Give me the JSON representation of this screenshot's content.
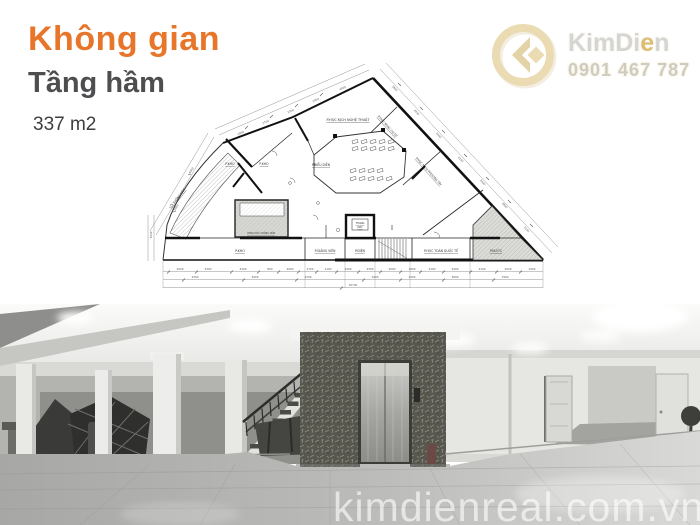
{
  "header": {
    "title": "Không gian",
    "subtitle": "Tầng hầm",
    "area": "337 m2"
  },
  "brand": {
    "name_pre": "KimDi",
    "name_accent": "e",
    "name_post": "n",
    "phone": "0901 467 787"
  },
  "photo_watermark": "kimdienreal.com.vn",
  "colors": {
    "accent_orange": "#e8762a",
    "title_gray": "#4e4e50",
    "logo_gold": "#e7d6aa",
    "plan_line": "#333333"
  },
  "plan": {
    "rooms": [
      {
        "t": "P.HỌC KỊCH NGHỆ THUẬT",
        "x": 208,
        "y": 46,
        "r": 0,
        "s": 3.4
      },
      {
        "t": "P.BIỂU DIỄN",
        "x": 181,
        "y": 91,
        "r": 0,
        "s": 3.1
      },
      {
        "t": "P.KHO",
        "x": 90,
        "y": 90,
        "r": 0,
        "s": 3.1
      },
      {
        "t": "P.KHO",
        "x": 124,
        "y": 90,
        "r": 0,
        "s": 3.1
      },
      {
        "t": "P.KHO",
        "x": 100,
        "y": 177,
        "r": 0,
        "s": 3.3
      },
      {
        "t": "P.GIẢNG VIÊN",
        "x": 185,
        "y": 177,
        "r": 0,
        "s": 3.1
      },
      {
        "t": "P.ĐIỆN",
        "x": 220,
        "y": 177,
        "r": 0,
        "s": 3.1
      },
      {
        "t": "THANG",
        "x": 220,
        "y": 149,
        "r": 0,
        "s": 2.5
      },
      {
        "t": "MÁY",
        "x": 220,
        "y": 153,
        "r": 0,
        "s": 2.5
      },
      {
        "t": "P.HỌC TOÁN QUỐC TẾ",
        "x": 301,
        "y": 177,
        "r": 0,
        "s": 3.1
      },
      {
        "t": "P.NƯỚC",
        "x": 356,
        "y": 177,
        "r": 0,
        "s": 3.1
      },
      {
        "t": "P.HỌC NHẠC CỤ DT",
        "x": 247,
        "y": 52,
        "r": 48,
        "s": 2.9
      },
      {
        "t": "P.HỌC N.CỤ PHƯƠNG TÂY",
        "x": 288,
        "y": 97,
        "r": 48,
        "s": 2.9
      },
      {
        "t": "LỐI XUỐNG HẦM",
        "x": 38,
        "y": 124,
        "r": -52,
        "s": 2.9
      },
      {
        "t": "VÙNG DỐC XUỐNG HẦM",
        "x": 121,
        "y": 159,
        "r": 0,
        "s": 2.3
      }
    ],
    "dims": [
      {
        "t": "2000",
        "x": 101,
        "y": 59,
        "r": -23
      },
      {
        "t": "2700",
        "x": 126,
        "y": 48,
        "r": -23
      },
      {
        "t": "2300",
        "x": 151,
        "y": 37,
        "r": -23
      },
      {
        "t": "2000",
        "x": 176,
        "y": 26,
        "r": -23
      },
      {
        "t": "4500",
        "x": 203,
        "y": 14,
        "r": -23
      },
      {
        "t": "4000",
        "x": 52,
        "y": 96,
        "r": -60
      },
      {
        "t": "3000",
        "x": 37,
        "y": 133,
        "r": -60
      },
      {
        "t": "3800",
        "x": 254,
        "y": 14,
        "r": 47
      },
      {
        "t": "4200",
        "x": 276,
        "y": 38,
        "r": 47
      },
      {
        "t": "2000",
        "x": 298,
        "y": 61,
        "r": 47
      },
      {
        "t": "4100",
        "x": 320,
        "y": 85,
        "r": 47
      },
      {
        "t": "2000",
        "x": 342,
        "y": 108,
        "r": 47
      },
      {
        "t": "4800",
        "x": 364,
        "y": 131,
        "r": 47
      },
      {
        "t": "2100",
        "x": 386,
        "y": 155,
        "r": 47
      },
      {
        "t": "2000",
        "x": 40,
        "y": 195,
        "r": 0
      },
      {
        "t": "2300",
        "x": 68,
        "y": 195,
        "r": 0
      },
      {
        "t": "4100",
        "x": 103,
        "y": 195,
        "r": 0
      },
      {
        "t": "800",
        "x": 130,
        "y": 195,
        "r": 0
      },
      {
        "t": "2000",
        "x": 150,
        "y": 195,
        "r": 0
      },
      {
        "t": "1700",
        "x": 170,
        "y": 195,
        "r": 0
      },
      {
        "t": "1100",
        "x": 188,
        "y": 195,
        "r": 0
      },
      {
        "t": "2400",
        "x": 208,
        "y": 195,
        "r": 0
      },
      {
        "t": "2300",
        "x": 230,
        "y": 195,
        "r": 0
      },
      {
        "t": "2000",
        "x": 252,
        "y": 195,
        "r": 0
      },
      {
        "t": "1600",
        "x": 272,
        "y": 195,
        "r": 0
      },
      {
        "t": "2100",
        "x": 292,
        "y": 195,
        "r": 0
      },
      {
        "t": "2400",
        "x": 315,
        "y": 195,
        "r": 0
      },
      {
        "t": "2100",
        "x": 342,
        "y": 195,
        "r": 0
      },
      {
        "t": "2000",
        "x": 368,
        "y": 195,
        "r": 0
      },
      {
        "t": "2400",
        "x": 392,
        "y": 195,
        "r": 0
      },
      {
        "t": "2300",
        "x": 55,
        "y": 203,
        "r": 0
      },
      {
        "t": "4900",
        "x": 115,
        "y": 203,
        "r": 0
      },
      {
        "t": "4700",
        "x": 168,
        "y": 203,
        "r": 0
      },
      {
        "t": "2400",
        "x": 235,
        "y": 203,
        "r": 0
      },
      {
        "t": "2300",
        "x": 272,
        "y": 203,
        "r": 0
      },
      {
        "t": "2600",
        "x": 315,
        "y": 203,
        "r": 0
      },
      {
        "t": "7900",
        "x": 365,
        "y": 203,
        "r": 0
      },
      {
        "t": "32700",
        "x": 213,
        "y": 211,
        "r": 0
      },
      {
        "t": "3940",
        "x": 12,
        "y": 160,
        "r": -90
      }
    ]
  }
}
